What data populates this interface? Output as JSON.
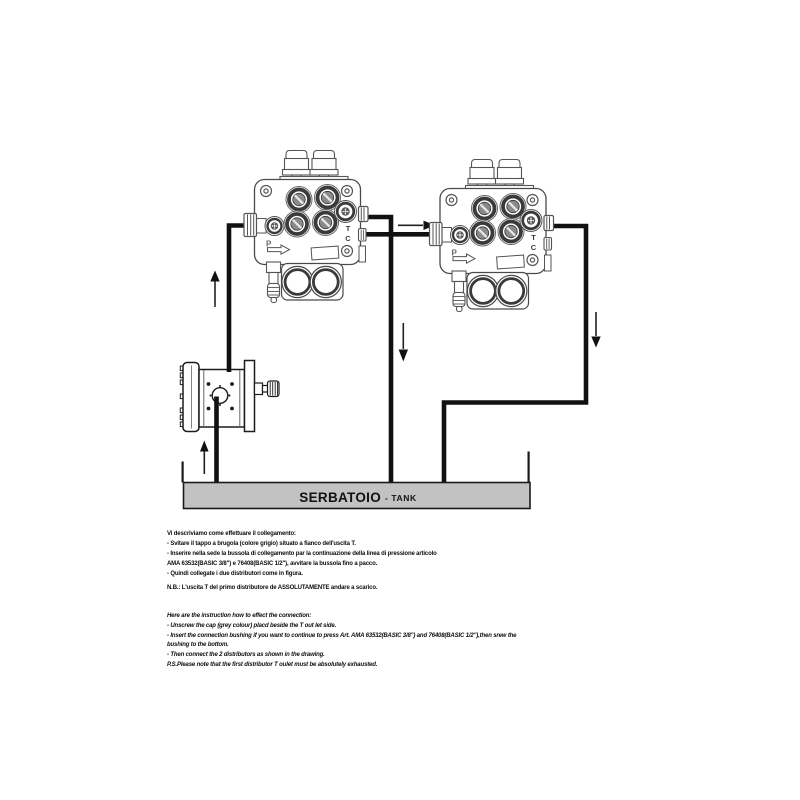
{
  "diagram": {
    "tank": {
      "label_primary": "SERBATOIO",
      "label_secondary": "- TANK",
      "fill_color": "#c2c2c2"
    },
    "valve_port_labels": {
      "p": "P",
      "t": "T",
      "c": "C"
    },
    "colors": {
      "pipe": "#111111",
      "line_art": "#4a4a4a",
      "pump_line": "#1c1c1c",
      "tank_fill": "#c2c2c2"
    }
  },
  "instructions_it": {
    "lines": [
      "Vi descriviamo come effettuare il collegamento:",
      "- Svitare il tappo a brugola (colore grigio) situato a fianco dell'uscita T.",
      "- Inserire nella sede la bussola di collegamento par la continuazione della linea di pressione articolo",
      "AMA 63532(BASIC 3/8\") e 76408(BASIC 1/2\"), avvitare la bussola fino a pacco.",
      "- Quindi collegate i due distributori come in figura.",
      "N.B.: L'uscita T del primo distributore de ASSOLUTAMENTE andare a scarico."
    ]
  },
  "instructions_en": {
    "lines": [
      "Here are the instruction how to effect the connection:",
      "- Unscrew the cap (grey colour) placd beside the T out let side.",
      "- Insert the connection bushing if you want to continue to press Art. AMA 63532(BASIC 3/8\") and 76408(BASIC 1/2\"),then srew the",
      "bushing to the bottom.",
      "- Then connect the 2 distributors as shown in the drawing.",
      "P.S.Please note that the first distributor T oulet must be absolutely exhausted."
    ]
  }
}
